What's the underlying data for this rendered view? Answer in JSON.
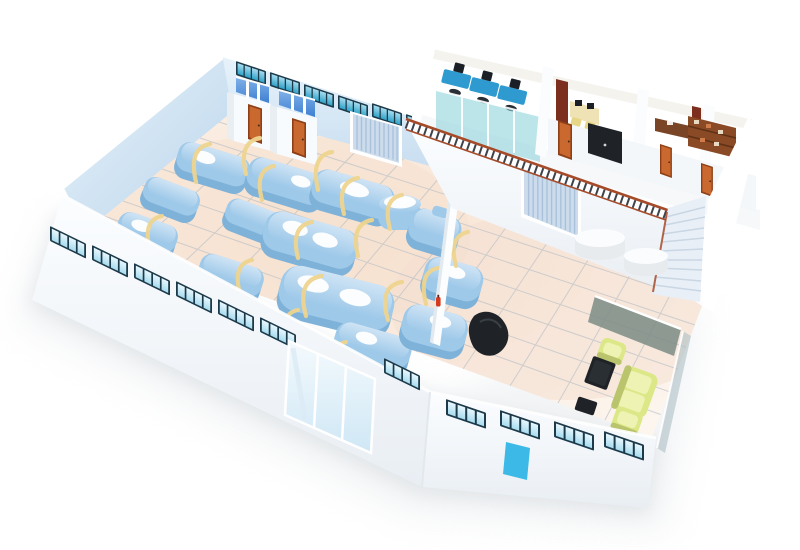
{
  "meta": {
    "kind": "3d-isometric-floor-plan",
    "scene": "cutaway rendering of a two-story industrial facility",
    "canvas": {
      "width": 800,
      "height": 550
    },
    "no_visible_text": true
  },
  "colors": {
    "page_bg": "#ffffff",
    "shadow_grey": "#d6dade",
    "wall_white": "#fbfdff",
    "wall_shade": "#e9eef3",
    "interior_wall_blue": "#b9d4ea",
    "interior_wall_blue_light": "#e8f3fb",
    "back_wall_blue": "#c7ddf0",
    "floor_peach": "#f7e3d2",
    "floor_peach_light": "#fdf7f0",
    "tile_grid": "#b9bec4",
    "machine_blue": "#9ec9e9",
    "machine_blue_dark": "#7fb2d9",
    "machine_blue_top": "#cfe4f5",
    "machine_oval_white": "#ffffff",
    "pipe_yellow": "#eed48e",
    "window_frame_dark": "#1d3a4a",
    "window_glass_teal": "#2fa3c9",
    "window_glass_light": "#a8dcef",
    "door_orange": "#c9692f",
    "door_orange_frame": "#8e3f16",
    "roller_door_grey": "#ccdcec",
    "roller_door_lines": "#a9c2da",
    "railing_red_brown": "#a64b2a",
    "baluster_dark": "#3c434b",
    "stall_blue": "#3e7fd2",
    "office_glass_teal": "#8fd4dc",
    "console_blue": "#2f9ad0",
    "bookshelf_dark_red": "#7c2f1e",
    "shelf_brown": "#8a4a26",
    "desk_cream": "#efe2b4",
    "chair_yellow": "#e6d687",
    "desk_wood_brown": "#7a4526",
    "furniture_black": "#1f2327",
    "sofa_green": "#dce788",
    "sofa_green_light": "#eef3b4",
    "sofa_green_dark": "#b9c46c",
    "service_door_cyan": "#3cb9e6",
    "stair_tread": "#e9eff6",
    "stair_line": "#c9d6e4",
    "lounge_glass_grey": "#7b8b85",
    "extinguisher_red": "#d43a1f"
  },
  "scene": {
    "production_hall": {
      "process_machines": 17,
      "storage_tank": 1,
      "pipe_hoses": 18,
      "window_strips_back_wall": 6,
      "roller_door": 1,
      "restroom_blocks": 2,
      "stall_panels_per_block": 3,
      "orange_doors": 2,
      "fire_extinguisher": 1
    },
    "mezzanine": {
      "rooms": [
        "control-room",
        "staff-office",
        "manager-office",
        "archive-room"
      ],
      "control_consoles": 3,
      "staff_desks": 1,
      "staff_chairs": 2,
      "bookshelves": 2,
      "archive_shelving_units": 1,
      "presentation_board": 1,
      "orange_doors": 3,
      "railing_balusters": 40,
      "staircase_steps": 10
    },
    "lobby": {
      "roller_door": 1,
      "round_tables": 2,
      "reception_counter": 1
    },
    "lounge": {
      "sofa": 1,
      "armchairs": 2,
      "coffee_table": 1,
      "footstool": 1,
      "glass_partitions": 2
    },
    "facade": {
      "window_strips": 11,
      "entrance_glass_panels": 3,
      "service_door": 1
    }
  }
}
